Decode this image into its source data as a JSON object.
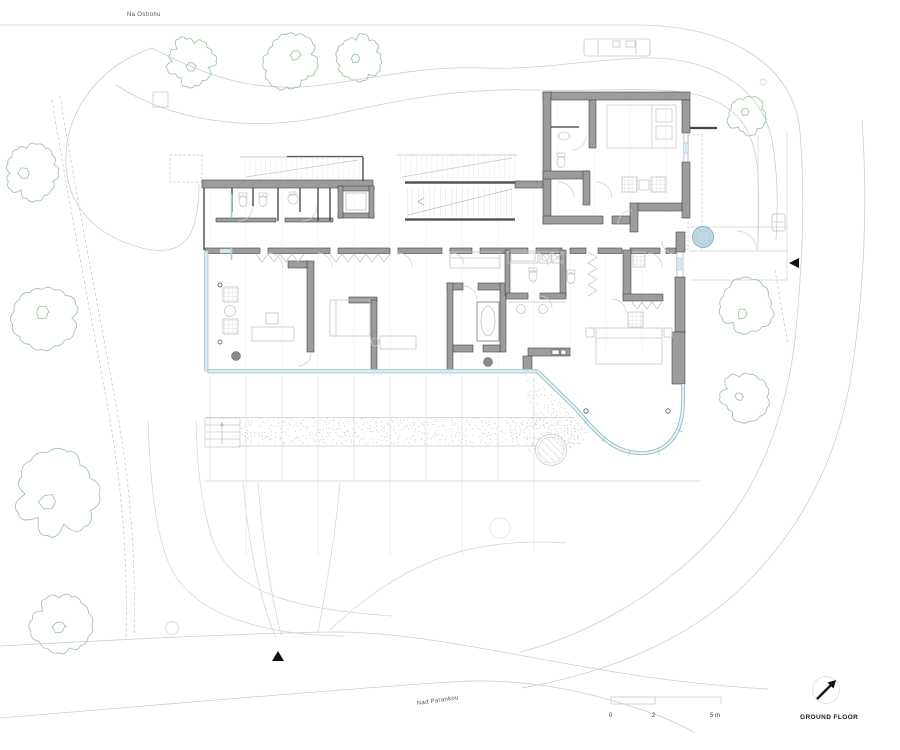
{
  "page": {
    "type": "architectural-site-plan",
    "drawing": "villa ground floor with garden"
  },
  "labels": {
    "street_top": "Na Ostrohu",
    "street_bottom": "Nad Paťankou",
    "title": "GROUND FLOOR"
  },
  "scale_bar": {
    "ticks": [
      "0",
      "2",
      "5 m"
    ]
  },
  "colors": {
    "wall_fill": "#9c9c9c",
    "wall_edge": "#474747",
    "partition": "#3c3c3c",
    "site_line": "#cdcdcd",
    "furniture": "#c6c6c6",
    "tree": "#a3c8a3",
    "stipple": "#b7cfb7",
    "glass": "#9fc2ce",
    "glass_fill": "#d9eaf0",
    "water_circle": "#bcd8e2",
    "marker": "#111111"
  },
  "trees": [
    {
      "x": 191,
      "y": 61,
      "r": 25,
      "s": 11
    },
    {
      "x": 291,
      "y": 62,
      "r": 28,
      "s": 22
    },
    {
      "x": 359,
      "y": 58,
      "r": 23,
      "s": 33
    },
    {
      "x": 747,
      "y": 116,
      "r": 20,
      "s": 44
    },
    {
      "x": 31,
      "y": 173,
      "r": 28,
      "s": 55
    },
    {
      "x": 45,
      "y": 318,
      "r": 33,
      "s": 66
    },
    {
      "x": 57,
      "y": 494,
      "r": 42,
      "s": 77
    },
    {
      "x": 62,
      "y": 625,
      "r": 31,
      "s": 88
    },
    {
      "x": 746,
      "y": 307,
      "r": 28,
      "s": 99
    },
    {
      "x": 744,
      "y": 397,
      "r": 25,
      "s": 110
    }
  ],
  "stipple_regions": [
    {
      "type": "rect",
      "x": 238,
      "y": 419,
      "w": 350,
      "h": 27
    },
    {
      "type": "poly",
      "points": [
        [
          527,
          374
        ],
        [
          573,
          409
        ],
        [
          590,
          430
        ],
        [
          570,
          455
        ],
        [
          527,
          452
        ]
      ]
    }
  ]
}
